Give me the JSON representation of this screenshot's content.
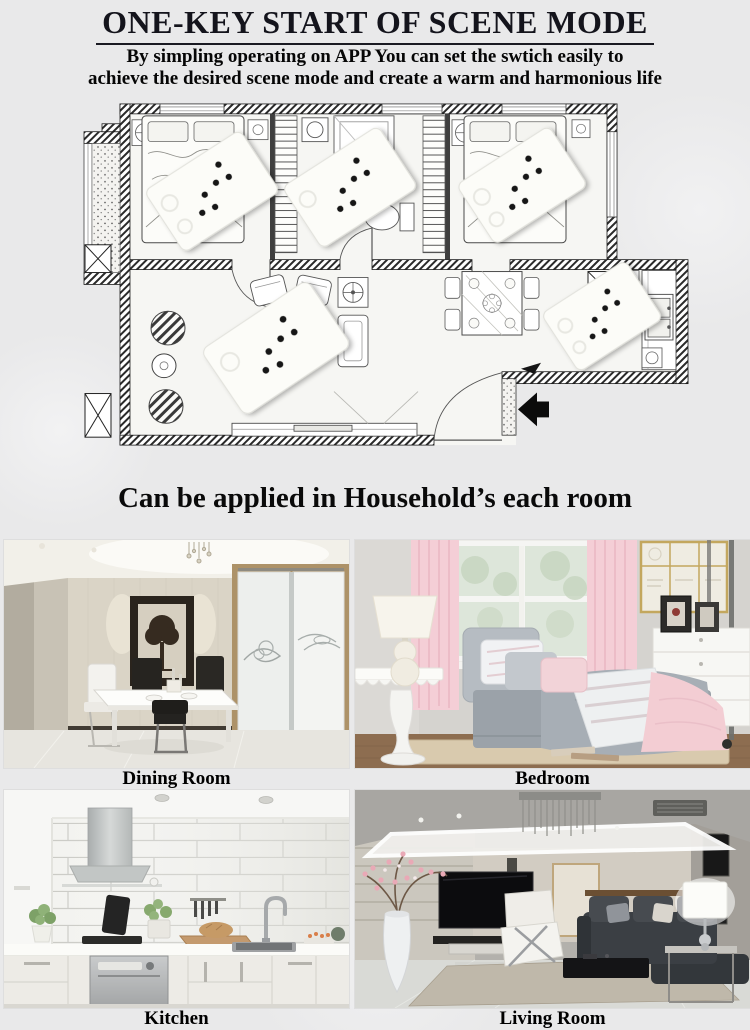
{
  "header": {
    "title": "ONE-KEY START OF SCENE MODE",
    "subtitle_line1": "By simpling operating on APP You can set the swtich easily to",
    "subtitle_line2": "achieve the desired scene mode and create a warm and harmonious life"
  },
  "caption": "Can be applied in Household’s each room",
  "floor_plan": {
    "switch_panel_count": 5,
    "dots_per_switch_panel": 6
  },
  "gallery": {
    "items": [
      {
        "label": "Dining Room"
      },
      {
        "label": "Bedroom"
      },
      {
        "label": "Kitchen"
      },
      {
        "label": "Living Room"
      }
    ]
  },
  "colors": {
    "page_background": "#e9e9ea",
    "title_text": "#14141c",
    "switch_panel": "#fcfcf8",
    "switch_dot": "#161616",
    "accent_pink": "#f4ced6",
    "entry_arrow": "#0b0b0b"
  }
}
